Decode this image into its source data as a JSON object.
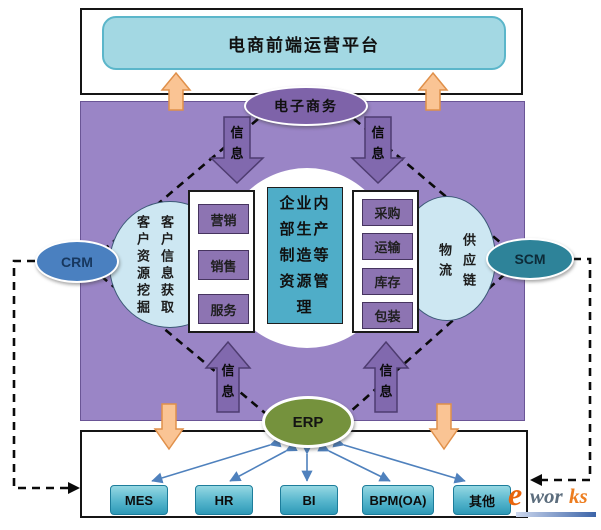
{
  "header": {
    "platform_title": "电商前端运营平台"
  },
  "nodes": {
    "ecommerce": "电子商务",
    "crm": "CRM",
    "scm": "SCM",
    "erp": "ERP"
  },
  "info_label": "信息",
  "left_ellipse": {
    "col_right": "客户信息获取",
    "col_left": "客户资源挖掘"
  },
  "right_ellipse": {
    "col_right": "供应链",
    "col_left": "物流"
  },
  "center_box": {
    "text": "企业内部生产制造等资源管理"
  },
  "marketing_boxes": [
    "营销",
    "销售",
    "服务"
  ],
  "supply_boxes": [
    "采购",
    "运输",
    "库存",
    "包装"
  ],
  "bottom_boxes": [
    "MES",
    "HR",
    "BI",
    "BPM(OA)",
    "其他"
  ],
  "logo": {
    "e": "e",
    "wor": "wor",
    "ks": "ks"
  },
  "colors": {
    "purple_frame": "#9a85c6",
    "dark_purple_node": "#7e63a9",
    "block_arrow_purple": "#8169ae",
    "teal_center": "#4fadc8",
    "cyan_title": "#a3d8e3",
    "light_blue_ellipse": "#cde7f2",
    "crm_blue": "#4a80c0",
    "scm_teal": "#2e8399",
    "erp_green": "#75923d",
    "orange_arrow": "#fac494",
    "connector_blue": "#4f81bd",
    "sysbox_teal": "#55b5cc"
  }
}
